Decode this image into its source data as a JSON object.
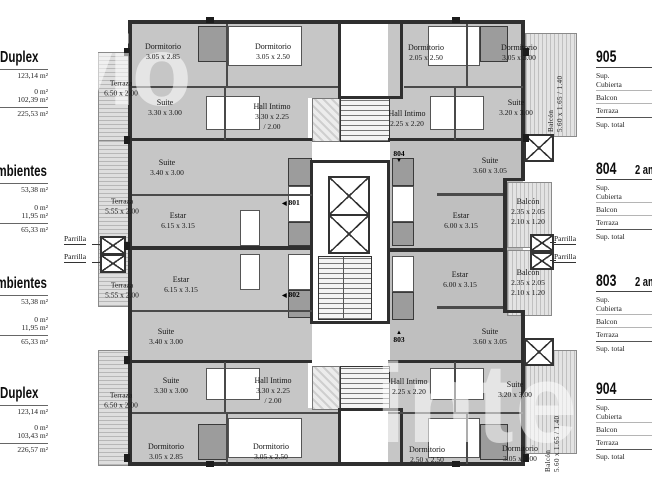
{
  "watermark": {
    "top_left": "vio",
    "bottom_right": "inte"
  },
  "left_panel": {
    "blocks": [
      {
        "title": "Duplex",
        "v1": "123,14 m²",
        "v2": "0 m²",
        "v3": "102,39 m²",
        "total": "225,53 m²"
      },
      {
        "title": "Ambientes",
        "v1": "53,38 m²",
        "v2": "0 m²",
        "v3": "11,95 m²",
        "total": "65,33 m²"
      },
      {
        "title": "Ambientes",
        "v1": "53,38 m²",
        "v2": "0 m²",
        "v3": "11,95 m²",
        "total": "65,33 m²"
      },
      {
        "title": "Duplex",
        "v1": "123,14 m²",
        "v2": "0 m²",
        "v3": "103,43 m²",
        "total": "226,57 m²"
      }
    ]
  },
  "right_panel": {
    "blocks": [
      {
        "number": "905",
        "suffix": "",
        "l1a": "Sup.",
        "l1b": "Cubierta",
        "l2": "Balcon",
        "l3": "Terraza",
        "l4": "Sup. total"
      },
      {
        "number": "804",
        "suffix": "2 ambientes",
        "l1a": "Sup.",
        "l1b": "Cubierta",
        "l2": "Balcon",
        "l3": "Terraza",
        "l4": "Sup. total"
      },
      {
        "number": "803",
        "suffix": "2 ambientes",
        "l1a": "Sup.",
        "l1b": "Cubierta",
        "l2": "Balcon",
        "l3": "Terraza",
        "l4": "Sup. total"
      },
      {
        "number": "904",
        "suffix": "",
        "l1a": "Sup.",
        "l1b": "Cubierta",
        "l2": "Balcon",
        "l3": "Terraza",
        "l4": "Sup. total"
      }
    ]
  },
  "plan": {
    "parrilla_label": "Parrilla",
    "units": {
      "u801": {
        "label": "801",
        "arrow": "◀"
      },
      "u802": {
        "label": "802",
        "arrow": "◀"
      },
      "u803": {
        "label": "803",
        "arrow": "▲"
      },
      "u804": {
        "label": "804",
        "arrow": "▼"
      }
    },
    "rooms": {
      "tl_dorm1": {
        "n": "Dormitorio",
        "d": "3.05 x 2.85"
      },
      "tl_dorm2": {
        "n": "Dormitorio",
        "d": "3.05 x 2.50"
      },
      "tl_suite": {
        "n": "Suite",
        "d": "3.30 x 3.00"
      },
      "tl_hall": {
        "n": "Hall Intimo",
        "d": "3.30 x 2.25",
        "d2": "/ 2.00"
      },
      "tr_dorm1": {
        "n": "Dormitorio",
        "d": "2.05 x 2.50"
      },
      "tr_dorm2": {
        "n": "Dormitorio",
        "d": "3.05 x 3.00"
      },
      "tr_suite": {
        "n": "Suite",
        "d": "3.20 x 3.00"
      },
      "tr_hall": {
        "n": "Hall Intimo",
        "d": "2.25 x 2.20"
      },
      "ml_suite_a": {
        "n": "Suite",
        "d": "3.40 x 3.00"
      },
      "ml_estar_a": {
        "n": "Estar",
        "d": "6.15 x 3.15"
      },
      "ml_estar_b": {
        "n": "Estar",
        "d": "6.15 x 3.15"
      },
      "ml_suite_b": {
        "n": "Suite",
        "d": "3.40 x 3.00"
      },
      "mr_suite_a": {
        "n": "Suite",
        "d": "3.60 x 3.05"
      },
      "mr_estar_a": {
        "n": "Estar",
        "d": "6.00 x 3.15"
      },
      "mr_estar_b": {
        "n": "Estar",
        "d": "6.00 x 3.15"
      },
      "mr_suite_b": {
        "n": "Suite",
        "d": "3.60 x 3.05"
      },
      "balc_804": {
        "n": "Balcón",
        "d": "2.35 x 2.05",
        "d2": "2.10 x 1.20"
      },
      "balc_803": {
        "n": "Balcón",
        "d": "2.35 x 2.05",
        "d2": "2.10 x 1.20"
      },
      "bl_suite": {
        "n": "Suite",
        "d": "3.30 x 3.00"
      },
      "bl_hall": {
        "n": "Hall Intimo",
        "d": "3.30 x 2.25",
        "d2": "/ 2.00"
      },
      "bl_dorm1": {
        "n": "Dormitorio",
        "d": "3.05 x 2.85"
      },
      "bl_dorm2": {
        "n": "Dormitorio",
        "d": "3.05 x 2.50"
      },
      "br_hall": {
        "n": "Hall Intimo",
        "d": "2.25 x 2.20"
      },
      "br_suite": {
        "n": "Suite",
        "d": "3.20 x 3.00"
      },
      "br_dorm1": {
        "n": "Dormitorio",
        "d": "2.50 x 2.50"
      },
      "br_dorm2": {
        "n": "Dormitorio",
        "d": "3.05 x 3.00"
      }
    },
    "terrazas": {
      "t_tl": {
        "n": "Terraza",
        "d": "6.50 x 2.00"
      },
      "t_ml_a": {
        "n": "Terraza",
        "d": "5.55 x 2.00"
      },
      "t_ml_b": {
        "n": "Terraza",
        "d": "5.55 x 2.00"
      },
      "t_bl": {
        "n": "Terraza",
        "d": "6.50 x 2.00"
      }
    },
    "balconies": {
      "b_tr": {
        "n": "Balcón",
        "d": "5.60 x 1.65 / 1.40"
      },
      "b_br": {
        "n": "Balcón",
        "d": "5.60 x 1.65 / 1.40"
      }
    }
  }
}
